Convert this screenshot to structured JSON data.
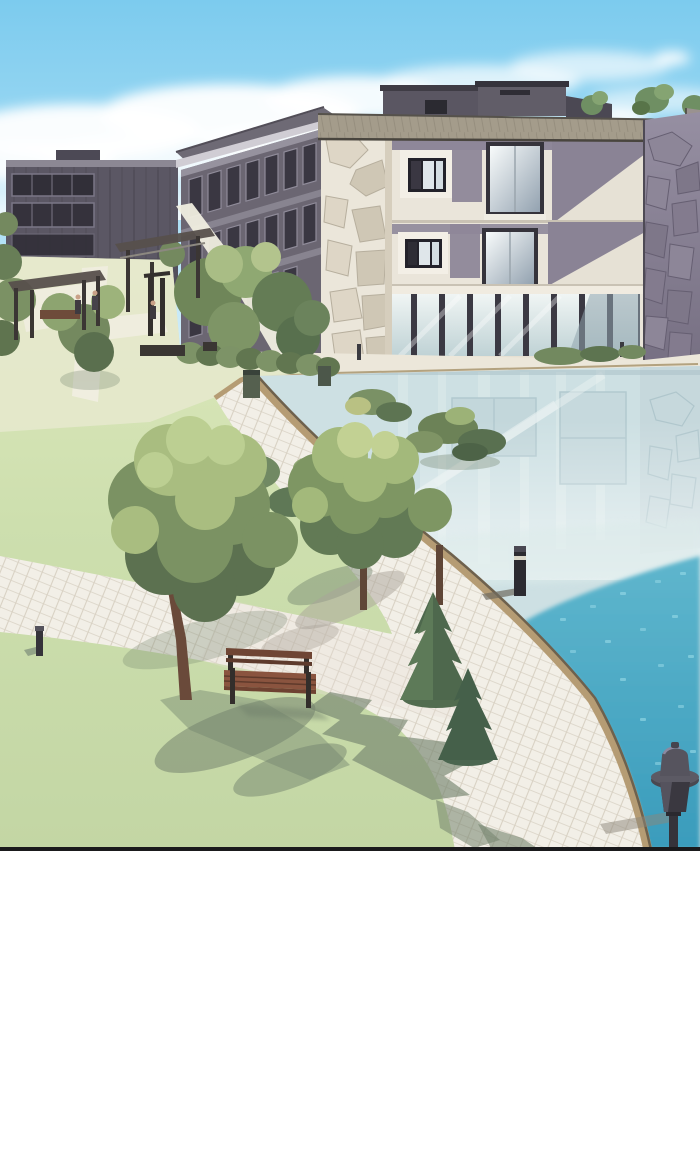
{
  "panel": {
    "kind": "webtoon-illustration-panel",
    "description": "Aerial view of a campus courtyard: stone-and-glass buildings, reflective pond, lawns, diagonal tiled path, wooden bench, bollard lights and a garden lamp; white margin below panel",
    "border_color": "#1a1a1c"
  },
  "colors": {
    "sky_top": "#7ccbee",
    "sky_mid": "#a5dcf4",
    "sky_horizon": "#e9f6fc",
    "cloud": "#ffffff",
    "grass_light": "#dfe9bd",
    "grass": "#cddfae",
    "grass_deep": "#c3d6a4",
    "courtyard_ground": "#e7e8cf",
    "path_tile": "#f2efe7",
    "path_grid": "#d8d1c3",
    "path_edge_tan": "#b59c74",
    "path_edge_dark": "#6e614d",
    "water_pale": "#cde0e3",
    "water_bright_top": "#5fb6cd",
    "water_bright_deep": "#3a9cbc",
    "water_sparkle": "#8fd4e2",
    "facade_cream": "#eae5da",
    "facade_mauve": "#8e8799",
    "stone_light": "#ebe6da",
    "stone_light_shade": "#ded6c6",
    "stone_wall_light": "#968fa2",
    "stone_wall_dark": "#766f82",
    "roof_tan": "#a49c8b",
    "wing_facade": "#6b6672",
    "far_block": "#5b5764",
    "window_dark": "#3a3742",
    "glass_pane_top": "#f0f5f4",
    "glass_pane_bottom": "#bfd2d5",
    "big_window_top": "#f8fbfb",
    "big_window_bottom": "#93a2b0",
    "foliage_light": "#a9bd80",
    "foliage_mid": "#7b9263",
    "foliage_dark": "#5c7150",
    "conifer": "#4e684d",
    "trunk": "#6a4a3a",
    "bench_wood": "#8a543f",
    "bench_frame": "#332e2b",
    "shadow_green": "#74846e",
    "shadow_path": "#aaa399",
    "metal_dark": "#35333a",
    "border": "#1a1a1c"
  },
  "scene": {
    "objects": [
      "sky",
      "clouds",
      "far-left-building",
      "left-wing-building",
      "rooftop-structures",
      "main-building",
      "stone-pillar",
      "stone-wall",
      "glass-curtain-wall",
      "base-walkway",
      "lawn",
      "courtyard",
      "pergolas",
      "trash-bins",
      "pond",
      "pond-reflections",
      "bright-water",
      "tiled-path",
      "pond-edge",
      "tree-shadows",
      "shrubs",
      "hedges",
      "large-tree",
      "medium-tree",
      "conifers",
      "bench",
      "bollard-lights",
      "garden-lamp",
      "panel-border"
    ]
  }
}
